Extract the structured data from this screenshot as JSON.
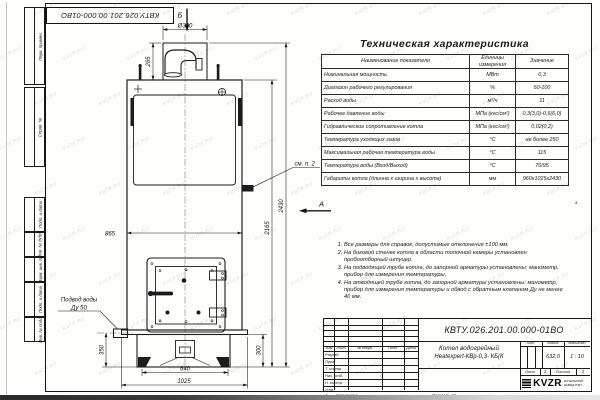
{
  "watermark": {
    "text": "KVZR.RU"
  },
  "frame": {
    "margin_labels": [
      "Перв. примен.",
      "Справ. №",
      "Подп. и дата",
      "Инв. № дубл.",
      "Взам. инв. №",
      "Подп. и дата",
      "Инв. № подл."
    ],
    "rotated_doc_number": "КВТУ.026.201.00.000-01ВО",
    "copied": "Копировал",
    "format": "Формат А3",
    "zone_bottom": "1",
    "zone_right": "а"
  },
  "table": {
    "title": "Техническая характеристика",
    "headers": [
      "Наименование показателя",
      "Единицы измерения",
      "Значение"
    ],
    "rows": [
      [
        "Номинальная мощность",
        "МВт",
        "0,3"
      ],
      [
        "Диапазон рабочего регулирования",
        "%",
        "50-100"
      ],
      [
        "Расход воды",
        "м³/ч",
        "11"
      ],
      [
        "Рабочее давление воды",
        "МПа (кгс/см²)",
        "0,3(3,0)-0,6(6,0)"
      ],
      [
        "Гидравлическое сопротивление котла",
        "МПа (кгс/см²)",
        "0,02(0,2)"
      ],
      [
        "Температура уходящих газов",
        "°С",
        "не более 250"
      ],
      [
        "Максимальная рабочая температура воды",
        "°С",
        "115"
      ],
      [
        "Температура воды (Вход/Выход)",
        "°С",
        "70/95"
      ],
      [
        "Габариты котла (длинна х ширина х высота)",
        "мм",
        "960х1025х2430"
      ]
    ]
  },
  "notes": [
    "Все размеры для справок, допустимые отклонения ±100 мм.",
    "На боковой стенке котла в области топочной камеры установлен пробоотборный штуцер.",
    "На подводящей трубе котла, до запорной арматуры установлены: манометр, прибор для измерения температуры.",
    "На отводящей трубе котла, до запорной арматуры установлены: манометр, прибор для измерения температуры и обвод с обратным клапаном Ду не менее 40 мм."
  ],
  "drawing": {
    "views": {
      "top": "Б",
      "front": "А"
    },
    "callouts": {
      "see_note": "см. п. 2",
      "water_supply_line1": "Подвод воды",
      "water_supply_line2": "Ду 50"
    },
    "dims": {
      "chimney_diameter": "Ø300",
      "chimney_height": "265",
      "body_width": "865",
      "overall_height": "2430",
      "body_height": "2165",
      "inlet_height": "350",
      "base_height": "300",
      "base_width": "640",
      "overall_width": "1025"
    }
  },
  "titleblock": {
    "doc_number": "КВТУ.026.201.00.000-01ВО",
    "product_line1": "Котел водогрейный",
    "product_line2": "Heatexpert-КВр-0,3- КБ(К",
    "header_cells": [
      "Изм",
      "Лист",
      "№ докум.",
      "Подп.",
      "Дата"
    ],
    "sign_rows": [
      "Разраб.",
      "Пров.",
      "Т. контр.",
      "Нач. отд.",
      "Н. контр.",
      "Утв."
    ],
    "lit_label": "Лит.",
    "mass_label": "Масса",
    "scale_label": "Масштаб",
    "mass": "632,0",
    "scale": "1 : 10",
    "sheet_label": "Лист",
    "sheet": "1",
    "sheets_label": "Листов",
    "sheets": "2",
    "logo": "KVZR",
    "logo_sub1": "КОТЕЛЬНЫЙ",
    "logo_sub2": "ЗАВОД РЭП"
  }
}
